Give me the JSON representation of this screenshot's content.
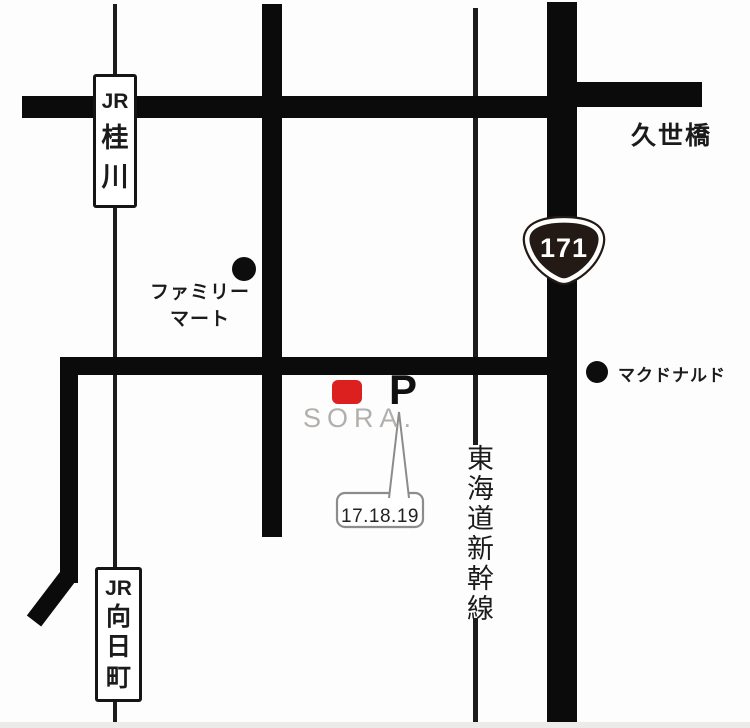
{
  "colors": {
    "road": "#0b0b0b",
    "railway": "#1c1c1c",
    "accent_red": "#dc1f1f",
    "logo_gray": "#b3afac",
    "callout_border": "#8c8c8c",
    "shield_fill": "#241a15",
    "bottom_strip": "#edebe8",
    "text_dark": "#1b1b1b"
  },
  "stations": {
    "katsuragawa": {
      "lines": [
        "JR",
        "桂",
        "川"
      ]
    },
    "mukomachi": {
      "lines": [
        "JR",
        "向",
        "日",
        "町"
      ]
    }
  },
  "landmarks": {
    "kuzebashi": "久世橋",
    "family_mart": {
      "line1": "ファミリー",
      "line2": "マート"
    },
    "mcdonalds": "マクドナルド",
    "shinkansen": "東海道新幹線"
  },
  "route_shield": {
    "number": "171"
  },
  "venue": {
    "logo": "SORA.",
    "parking_label": "P",
    "parking_note": "17.18.19"
  }
}
